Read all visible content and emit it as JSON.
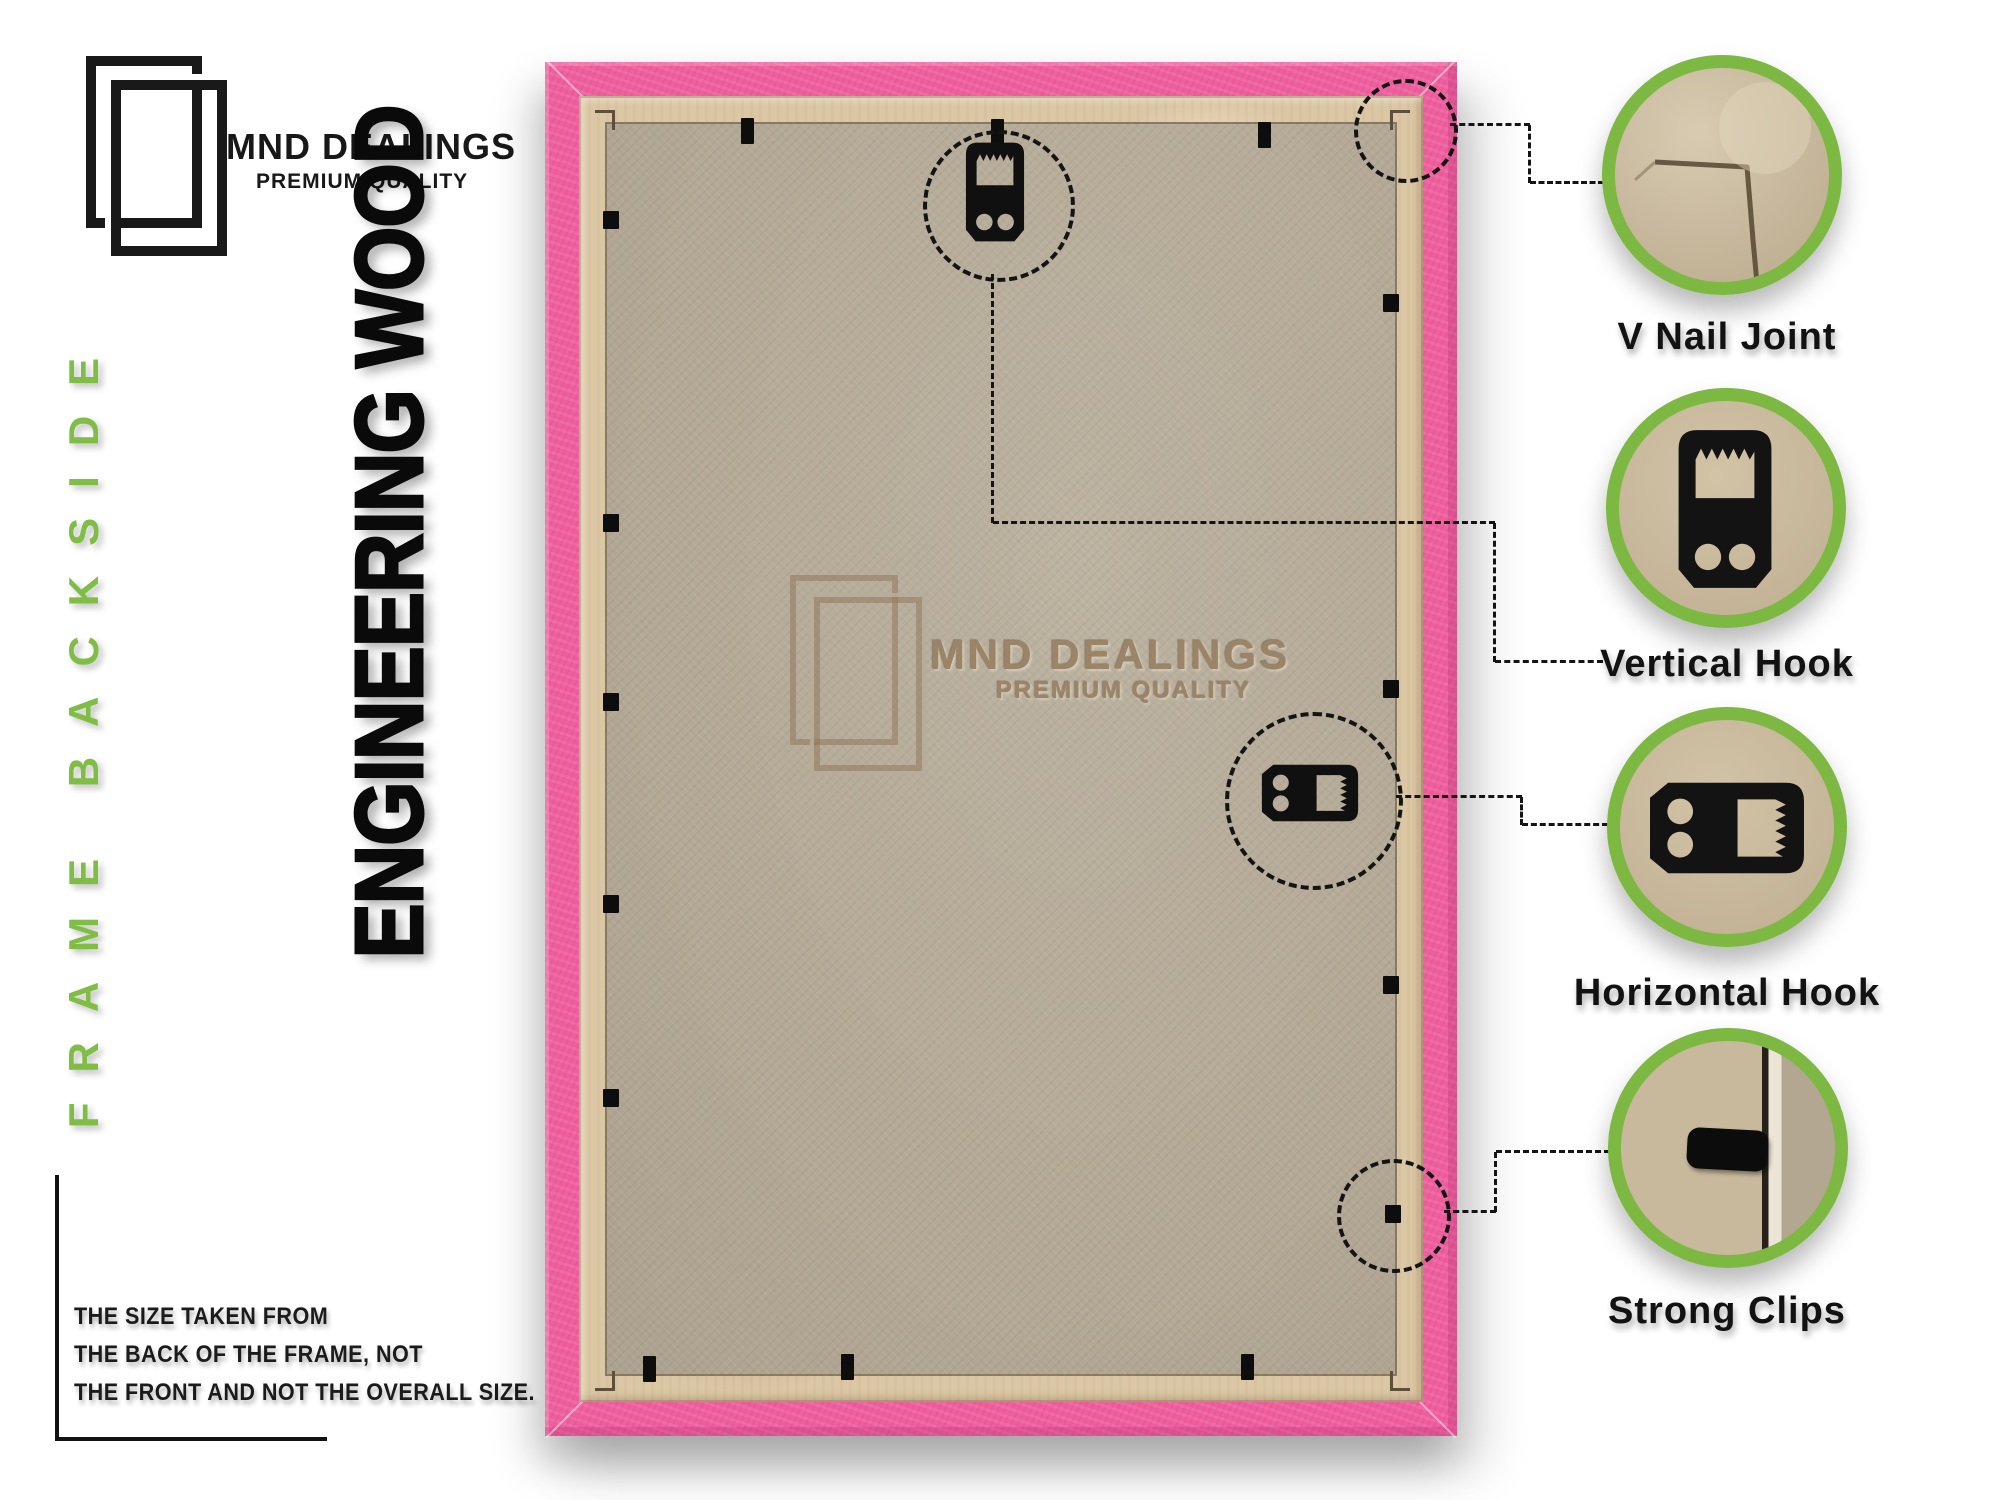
{
  "brand": {
    "name": "MND DEALINGS",
    "tagline": "PREMIUM QUALITY"
  },
  "side_label": "FRAME BACKSIDE",
  "headline": "ENGINEERING WOOD",
  "watermark": {
    "name": "MND DEALINGS",
    "tagline": "PREMIUM QUALITY"
  },
  "callouts": [
    {
      "id": "v-nail-joint",
      "label": "V Nail Joint"
    },
    {
      "id": "vertical-hook",
      "label": "Vertical Hook"
    },
    {
      "id": "horizontal-hook",
      "label": "Horizontal Hook"
    },
    {
      "id": "strong-clips",
      "label": "Strong Clips"
    }
  ],
  "note": {
    "lines": [
      "THE SIZE TAKEN FROM",
      "THE BACK OF THE FRAME, NOT",
      "THE FRONT AND NOT THE OVERALL SIZE."
    ]
  },
  "colors": {
    "accent_green": "#7db843",
    "frame_pink": "#ef5f9e",
    "wood_tan": "#dcc7a5",
    "mdf_board": "#b7ac99",
    "ink": "#141414",
    "watermark_brown": "#967d5f"
  }
}
